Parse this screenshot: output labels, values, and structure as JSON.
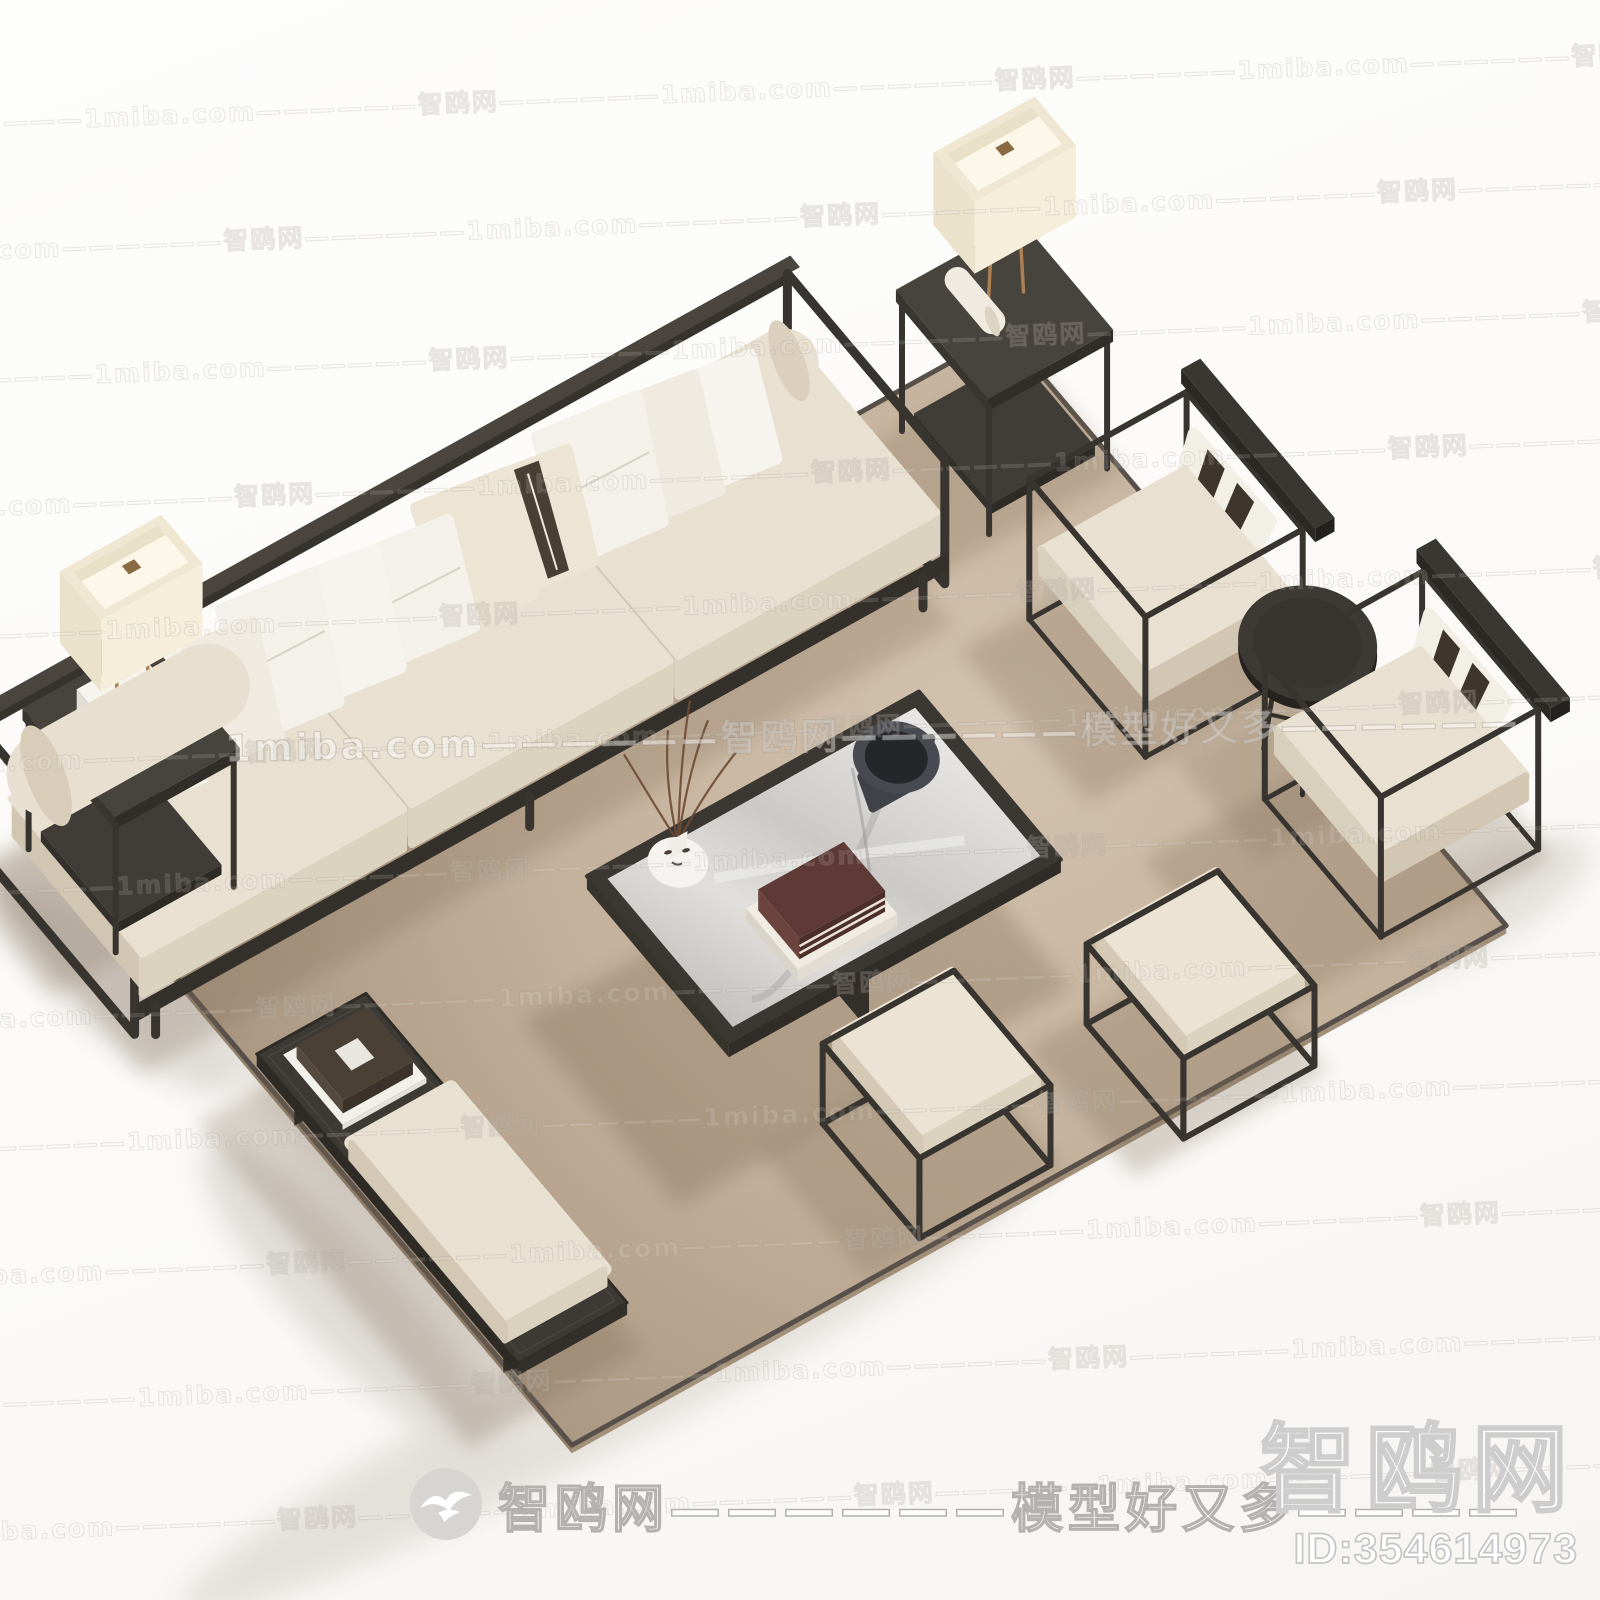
{
  "watermarks": {
    "tile_text": "智鸥网——————1miba.com——————",
    "tile_rows": 12,
    "tile_repeats": 4,
    "center_text": "1miba.com——————智鸥网——————模型好又多——————",
    "footer_text": "智鸥网——————模型好又多————",
    "footer_logo": "seagull-logo",
    "corner_brand": "智鸥网",
    "corner_id": "ID:354614973"
  },
  "scene": {
    "type": "3d-furniture-render",
    "description": "New Chinese style living-room furniture set rendered in isometric view on a beige suede rug: a long three-seat sofa with scatter pillows and bolsters, two metal-frame side tables with cream box lamps, a marble-top coffee table with bowl, books and face vase, two cube armchairs with striped pillows, a round tea table, two square stools and a low bench with cushion and tray.",
    "colors": {
      "floor": "#fbfaf8",
      "rug": "#c6b29c",
      "rug_trim": "#57504a",
      "frame_dark": "#38342f",
      "cushion_cream": "#e8e0d1",
      "pillow_white": "#f6f4ee",
      "pillow_dark_band": "#4a3f35",
      "marble": "#d8d7d4",
      "brass": "#ad8054",
      "shadow": "#7e6a53"
    },
    "items": [
      {
        "name": "rug"
      },
      {
        "name": "three-seat-sofa",
        "pillows": 10,
        "bolsters": 2
      },
      {
        "name": "side-table-with-lamp",
        "count": 2
      },
      {
        "name": "coffee-table",
        "decor": [
          "bowl",
          "books",
          "face-vase-with-twigs"
        ]
      },
      {
        "name": "armchair",
        "count": 2,
        "pillow": "striped"
      },
      {
        "name": "round-tea-table"
      },
      {
        "name": "square-stool",
        "count": 2
      },
      {
        "name": "bench",
        "decor": [
          "tray-with-book",
          "seat-cushion"
        ]
      }
    ]
  }
}
